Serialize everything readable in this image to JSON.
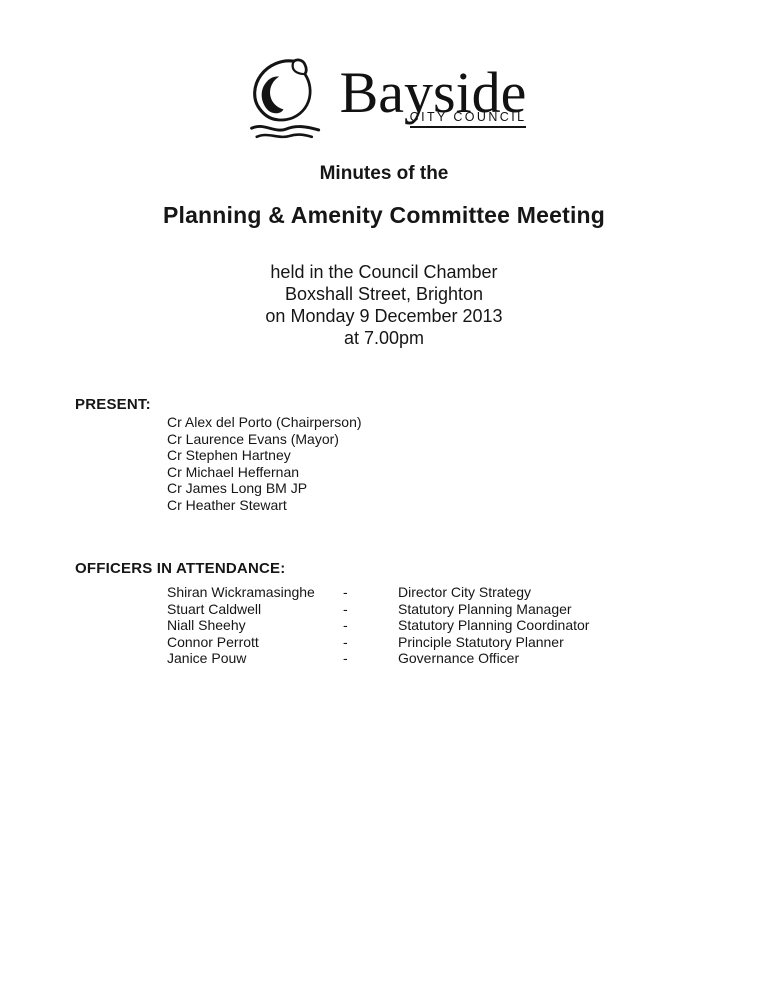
{
  "logo": {
    "name": "Bayside",
    "subtitle": "CITY COUNCIL",
    "icon": "shell-with-waves"
  },
  "heading": {
    "pre_title": "Minutes of the",
    "title": "Planning & Amenity Committee Meeting",
    "venue_lines": [
      "held in the Council Chamber",
      "Boxshall Street, Brighton",
      "on Monday 9 December 2013",
      "at 7.00pm"
    ]
  },
  "present": {
    "label": "PRESENT:",
    "members": [
      "Cr Alex del Porto (Chairperson)",
      "Cr Laurence Evans (Mayor)",
      "Cr Stephen Hartney",
      "Cr Michael Heffernan",
      "Cr James Long BM JP",
      "Cr Heather Stewart"
    ]
  },
  "officers": {
    "label": "OFFICERS IN ATTENDANCE:",
    "separator": "-",
    "rows": [
      {
        "name": "Shiran Wickramasinghe",
        "role": "Director City Strategy"
      },
      {
        "name": "Stuart Caldwell",
        "role": "Statutory Planning Manager"
      },
      {
        "name": "Niall Sheehy",
        "role": "Statutory Planning Coordinator"
      },
      {
        "name": "Connor Perrott",
        "role": "Principle Statutory Planner"
      },
      {
        "name": "Janice Pouw",
        "role": "Governance Officer"
      }
    ]
  },
  "colors": {
    "text": "#161616",
    "background": "#ffffff"
  }
}
